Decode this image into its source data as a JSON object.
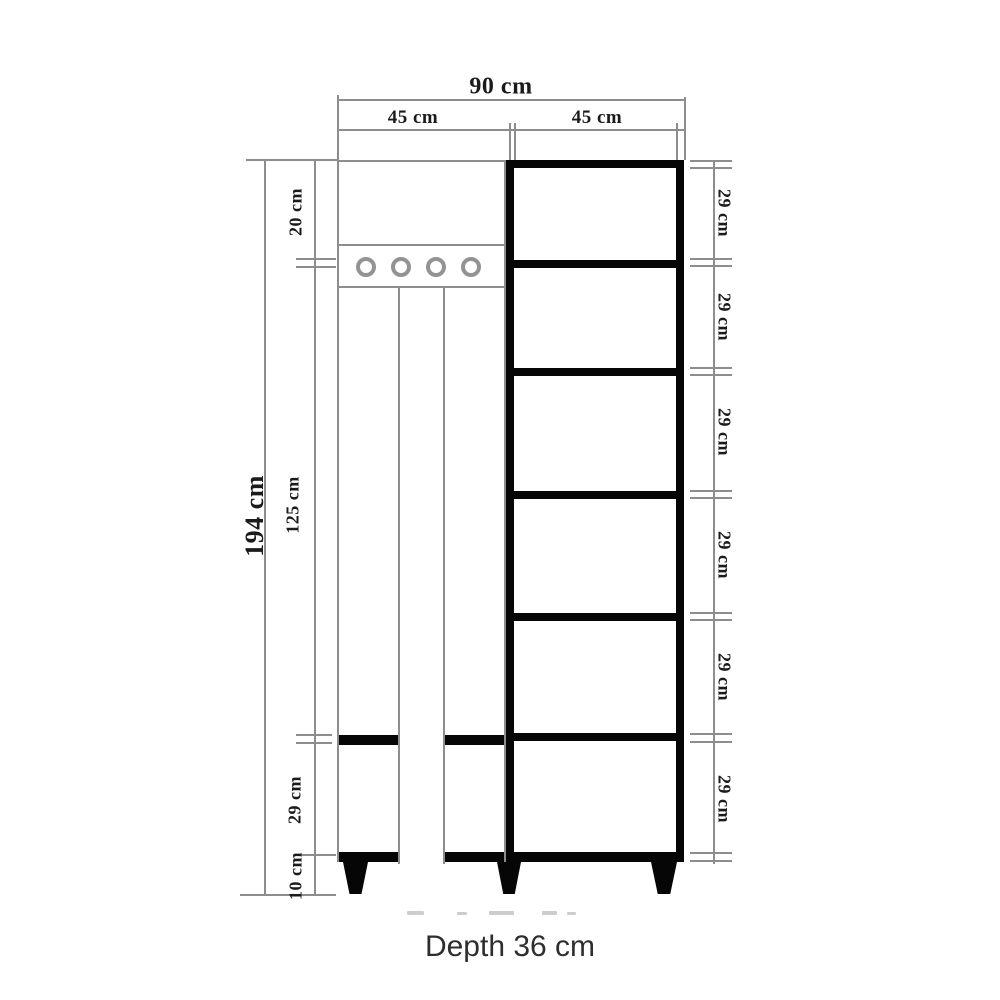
{
  "drawing": {
    "dimensions": {
      "overall_width": "90 cm",
      "left_section_width": "45 cm",
      "right_section_width": "45 cm",
      "overall_height": "194 cm",
      "left_segments": {
        "hooks_panel": "20 cm",
        "middle_panel": "125 cm",
        "lower_compartment": "29 cm",
        "legs": "10 cm"
      },
      "right_shelves": [
        "29 cm",
        "29 cm",
        "29 cm",
        "29 cm",
        "29 cm",
        "29 cm"
      ],
      "depth": "Depth 36 cm"
    },
    "colors": {
      "dimension_line": "#8d8d8d",
      "solid_black": "#060606",
      "label_text": "#1b1b1b",
      "footer_text": "#2e2e2e"
    }
  }
}
